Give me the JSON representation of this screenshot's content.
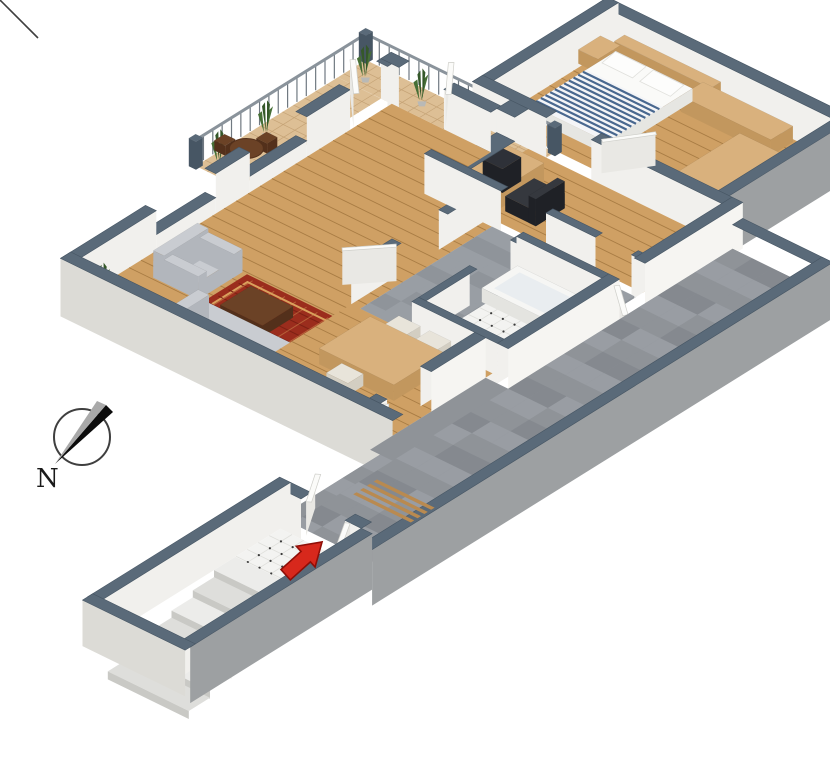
{
  "meta": {
    "title": "3D isometric floor plan",
    "background": "#ffffff"
  },
  "compass": {
    "label": "N"
  },
  "entrance": {
    "marker": "red-arrow"
  },
  "legend": {
    "rooms": [
      "balcony",
      "bedroom",
      "office",
      "living-room",
      "dining-area",
      "entry-hall",
      "bathroom",
      "passage",
      "terrace",
      "stair-corridor"
    ],
    "furniture": [
      "double-bed",
      "pillows",
      "headboard",
      "nightstand",
      "sideboard",
      "wardrobe",
      "desk",
      "computer",
      "desk-chair",
      "sofa",
      "armchair",
      "rug",
      "coffee-table",
      "kitchen-table",
      "kitchen-chairs",
      "balcony-table",
      "balcony-chairs",
      "bathtub",
      "sink",
      "bench",
      "plants",
      "railing",
      "stairs"
    ]
  },
  "colors": {
    "wallTop": "#5a6a79",
    "wallEdge": "#475664",
    "faceWhite": "#f1f0ed",
    "faceWhite2": "#f6f5f2",
    "faceShade": "#dcdbd6",
    "faceGray": "#9da0a2",
    "floorWood": "#cfa064",
    "floorWoodLine": "#a87c44",
    "balconyFloor": "#ddbf95",
    "balconyLine": "#c5a376",
    "tileGrayA": "#999ea4",
    "tileGrayB": "#8f949a",
    "terraceA": "#8f9398",
    "terraceB": "#999da3",
    "terraceC": "#85898f",
    "bathWhite": "#f3f3f1",
    "tileLine": "#dfdfdb",
    "dot": "#3a3a3a",
    "stepA": "#ececea",
    "stepB": "#dededb",
    "stepEdge": "#c9c9c5",
    "rug": "#9b2d1d",
    "rugBorder": "#d9a05c",
    "rugDark": "#7d2114",
    "sofa": "#c9ccd1",
    "sofaSide": "#b2b6bc",
    "woodLight": "#d9b17d",
    "woodLightSide": "#c2975e",
    "woodDark": "#6b4226",
    "woodDarkSide": "#53301b",
    "dark": "#2e3138",
    "darkSide": "#1f2126",
    "chairDark": "#35383e",
    "mattress": "#fafaf8",
    "mattressSide": "#e6e6e2",
    "blanket": "#f4f5f7",
    "blanketStripe": "#49688f",
    "chairLight": "#e8e4da",
    "chairLightSide": "#d3cec2",
    "doorFill": "#fbfbf9",
    "doorFace": "#e9e8e4",
    "doorEdge": "#cfcfca",
    "rail": "#8a939b",
    "baluster": "#707981",
    "plant": "#466f36",
    "plantDark": "#35582a",
    "pot": "#b9b9b6",
    "arrow": "#d7281c",
    "arrowEdge": "#8f0e07",
    "compass": "#3f3f3f"
  }
}
